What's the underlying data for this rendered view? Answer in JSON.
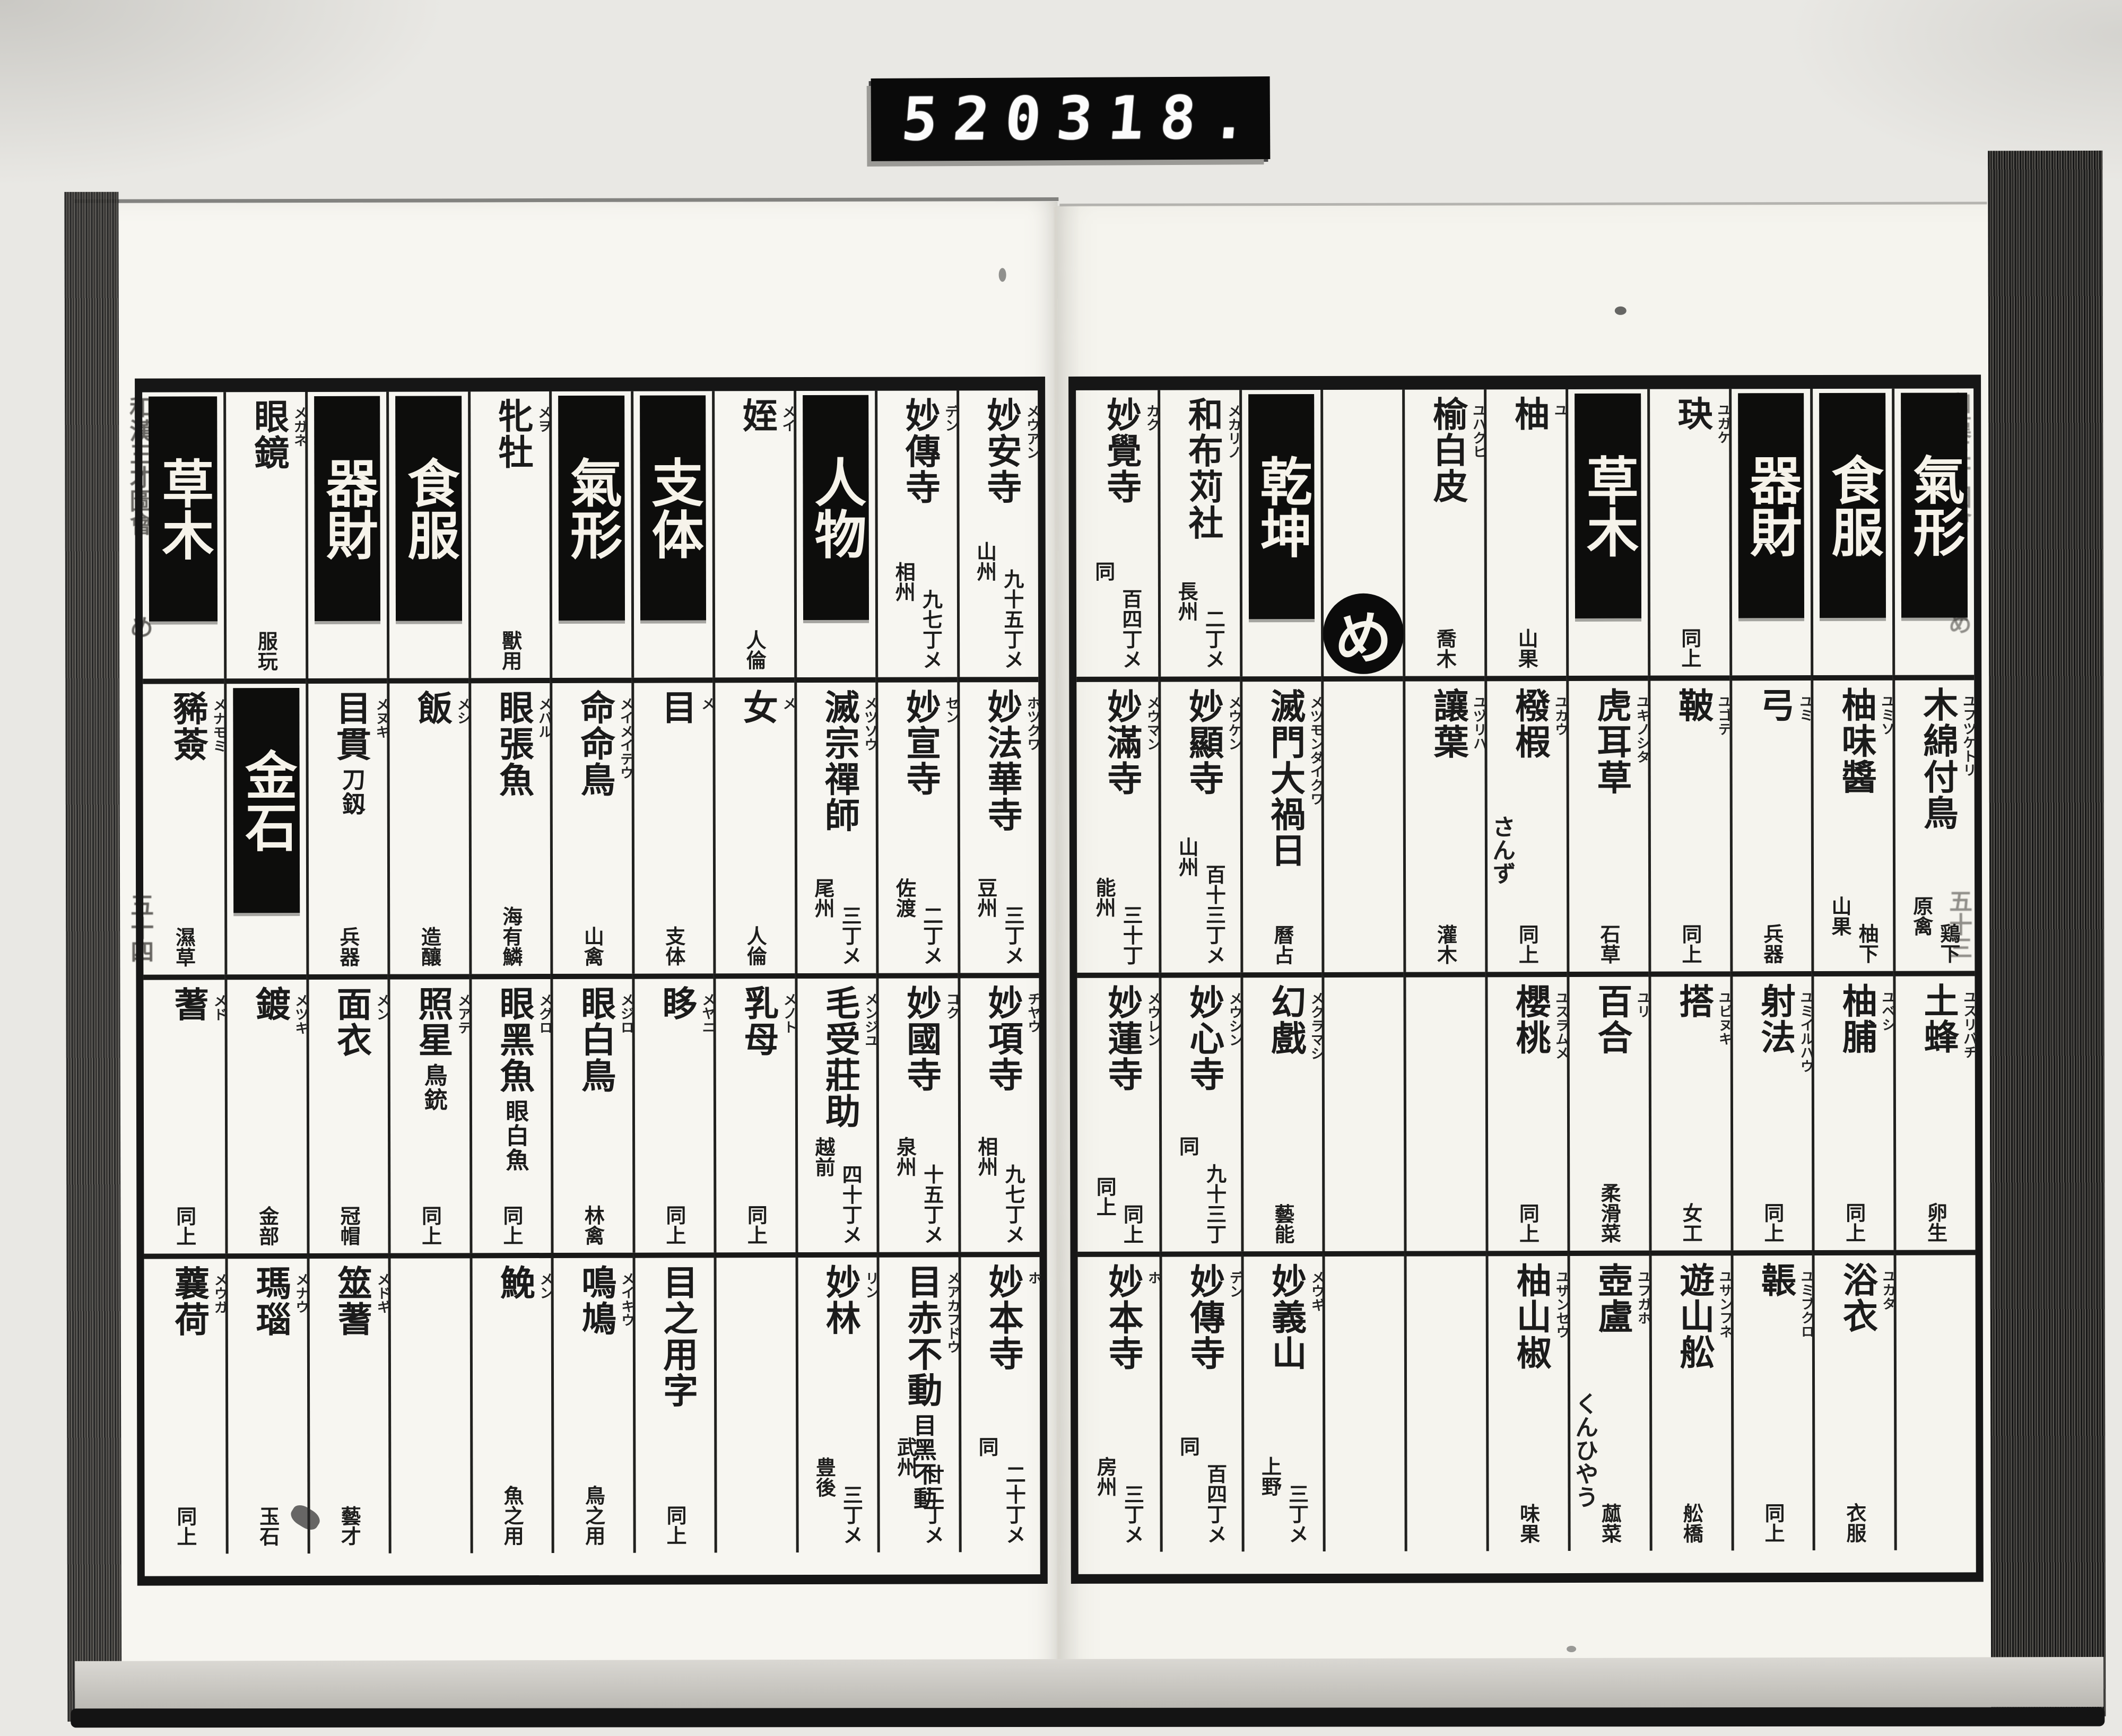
{
  "counter": {
    "left": "520",
    "right": "318."
  },
  "margins": {
    "left": {
      "title": "和漢三才圖會",
      "section": "め",
      "page": "五十四"
    },
    "right": {
      "title": "和漢三才圖會",
      "section": "め",
      "page": "五十三"
    }
  },
  "pages": [
    {
      "side": "right",
      "columns": [
        {
          "cells": [
            {
              "type": "header",
              "text": "氣形"
            },
            {
              "type": "entry",
              "text": "木綿付鳥",
              "furigana": "ユフツケトリ",
              "notes": [
                "原禽",
                "鶏下"
              ]
            },
            {
              "type": "entry",
              "text": "土蜂",
              "furigana": "ユスリバチ",
              "notes": [
                "卵生"
              ]
            },
            {
              "type": "empty"
            }
          ]
        },
        {
          "cells": [
            {
              "type": "header",
              "text": "食服"
            },
            {
              "type": "entry",
              "text": "柚味醬",
              "furigana": "ユミソ",
              "notes": [
                "山果",
                "柚下"
              ]
            },
            {
              "type": "entry",
              "text": "柚脯",
              "furigana": "ユベシ",
              "notes": [
                "同上"
              ]
            },
            {
              "type": "entry",
              "text": "浴衣",
              "furigana": "ユカタ",
              "notes": [
                "衣服"
              ]
            }
          ]
        },
        {
          "cells": [
            {
              "type": "header",
              "text": "器財"
            },
            {
              "type": "entry",
              "text": "弓",
              "furigana": "ユミ",
              "notes": [
                "兵器"
              ]
            },
            {
              "type": "entry",
              "text": "射法",
              "furigana": "ユミイルハウ",
              "notes": [
                "同上"
              ]
            },
            {
              "type": "entry",
              "text": "韔",
              "furigana": "ユミブクロ",
              "notes": [
                "同上"
              ]
            }
          ]
        },
        {
          "cells": [
            {
              "type": "entry",
              "text": "玦",
              "furigana": "ユガケ",
              "notes": [
                "同上"
              ]
            },
            {
              "type": "entry",
              "text": "鞁",
              "furigana": "ユゴテ",
              "notes": [
                "同上"
              ]
            },
            {
              "type": "entry",
              "text": "搭",
              "furigana": "ユビヌキ",
              "notes": [
                "女工"
              ]
            },
            {
              "type": "entry",
              "text": "遊山舩",
              "furigana": "ユサンフネ",
              "notes": [
                "舩橋"
              ]
            }
          ]
        },
        {
          "cells": [
            {
              "type": "header",
              "text": "草木"
            },
            {
              "type": "entry",
              "text": "虎耳草",
              "furigana": "ユキノシタ",
              "notes": [
                "石草"
              ]
            },
            {
              "type": "entry",
              "text": "百合",
              "furigana": "ユリ",
              "notes": [
                "柔滑菜"
              ]
            },
            {
              "type": "entry",
              "text": "壺盧",
              "furigana": "ユフガホ",
              "kana": "くんひやう",
              "notes": [
                "蓏菜"
              ]
            }
          ]
        },
        {
          "cells": [
            {
              "type": "entry",
              "text": "柚",
              "furigana": "ユ",
              "notes": [
                "山果"
              ]
            },
            {
              "type": "entry",
              "text": "橃椵",
              "furigana": "ユカウ",
              "kana": "さんず",
              "notes": [
                "同上"
              ]
            },
            {
              "type": "entry",
              "text": "櫻桃",
              "furigana": "ユスラムメ",
              "notes": [
                "同上"
              ]
            },
            {
              "type": "entry",
              "text": "柚山椒",
              "furigana": "ユザンセウ",
              "notes": [
                "味果"
              ]
            }
          ]
        },
        {
          "cells": [
            {
              "type": "entry",
              "text": "榆白皮",
              "furigana": "ユハクヒ",
              "notes": [
                "喬木"
              ]
            },
            {
              "type": "entry",
              "text": "讓葉",
              "furigana": "ユヅリハ",
              "notes": [
                "灌木"
              ]
            },
            {
              "type": "empty"
            },
            {
              "type": "empty"
            }
          ]
        },
        {
          "cells": [
            {
              "type": "marker",
              "text": "め"
            },
            {
              "type": "empty"
            },
            {
              "type": "empty"
            },
            {
              "type": "empty"
            }
          ]
        },
        {
          "cells": [
            {
              "type": "header",
              "text": "乾坤"
            },
            {
              "type": "entry",
              "text": "滅門大禍日",
              "furigana": "メツモンダイクワ",
              "notes": [
                "曆占"
              ]
            },
            {
              "type": "entry",
              "text": "幻戲",
              "furigana": "メクラマシ",
              "notes": [
                "藝能"
              ]
            },
            {
              "type": "entry",
              "text": "妙義山",
              "furigana": "メウギ",
              "notes": [
                "上野",
                "三丁メ"
              ]
            }
          ]
        },
        {
          "cells": [
            {
              "type": "entry",
              "text": "和布苅社",
              "furigana": "メカリノ",
              "notes": [
                "長州",
                "二丁メ"
              ]
            },
            {
              "type": "entry",
              "text": "妙顯寺",
              "furigana": "メウケン",
              "notes": [
                "山州",
                "百十三丁メ"
              ]
            },
            {
              "type": "entry",
              "text": "妙心寺",
              "furigana": "メウシン",
              "notes": [
                "同",
                "九十三丁"
              ]
            },
            {
              "type": "entry",
              "text": "妙傳寺",
              "furigana": "デン",
              "notes": [
                "同",
                "百四丁メ"
              ]
            }
          ]
        },
        {
          "cells": [
            {
              "type": "entry",
              "text": "妙覺寺",
              "furigana": "カク",
              "notes": [
                "同",
                "百四丁メ"
              ]
            },
            {
              "type": "entry",
              "text": "妙滿寺",
              "furigana": "メウマン",
              "notes": [
                "能州",
                "三十丁"
              ]
            },
            {
              "type": "entry",
              "text": "妙蓮寺",
              "furigana": "メウレン",
              "notes": [
                "同上",
                "同上"
              ]
            },
            {
              "type": "entry",
              "text": "妙本寺",
              "furigana": "ホ",
              "notes": [
                "房州",
                "三丁メ"
              ]
            }
          ]
        }
      ]
    },
    {
      "side": "left",
      "columns": [
        {
          "cells": [
            {
              "type": "entry",
              "text": "妙安寺",
              "furigana": "メウアン",
              "notes": [
                "山州",
                "九十五丁メ"
              ]
            },
            {
              "type": "entry",
              "text": "妙法華寺",
              "furigana": "ホツクワ",
              "notes": [
                "豆州",
                "三丁メ"
              ]
            },
            {
              "type": "entry",
              "text": "妙項寺",
              "furigana": "チヤウ",
              "notes": [
                "相州",
                "九七丁メ"
              ]
            },
            {
              "type": "entry",
              "text": "妙本寺",
              "furigana": "ホ",
              "notes": [
                "同",
                "二十丁メ"
              ]
            }
          ]
        },
        {
          "cells": [
            {
              "type": "entry",
              "text": "妙傳寺",
              "furigana": "デン",
              "notes": [
                "相州",
                "九七丁メ"
              ]
            },
            {
              "type": "entry",
              "text": "妙宣寺",
              "furigana": "セン",
              "notes": [
                "佐渡",
                "二丁メ"
              ]
            },
            {
              "type": "entry",
              "text": "妙國寺",
              "furigana": "コク",
              "notes": [
                "泉州",
                "十五丁メ"
              ]
            },
            {
              "type": "entry",
              "text": "目赤不動",
              "sub": "目黑不動",
              "furigana": "メアカフドウ",
              "notes": [
                "武州",
                "廿二丁メ"
              ]
            }
          ]
        },
        {
          "cells": [
            {
              "type": "header",
              "text": "人物"
            },
            {
              "type": "entry",
              "text": "滅宗禪師",
              "furigana": "メツソウ",
              "notes": [
                "尾州",
                "三丁メ"
              ]
            },
            {
              "type": "entry",
              "text": "毛受莊助",
              "furigana": "メンジユ",
              "notes": [
                "越前",
                "四十丁メ"
              ]
            },
            {
              "type": "entry",
              "text": "妙林",
              "furigana": "リン",
              "notes": [
                "豊後",
                "三丁メ"
              ]
            }
          ]
        },
        {
          "cells": [
            {
              "type": "entry",
              "text": "姪",
              "furigana": "メイ",
              "notes": [
                "人倫"
              ]
            },
            {
              "type": "entry",
              "text": "女",
              "furigana": "メ",
              "notes": [
                "人倫"
              ]
            },
            {
              "type": "entry",
              "text": "乳母",
              "furigana": "メノト",
              "notes": [
                "同上"
              ]
            },
            {
              "type": "empty"
            }
          ]
        },
        {
          "cells": [
            {
              "type": "header",
              "text": "支体"
            },
            {
              "type": "entry",
              "text": "目",
              "furigana": "メ",
              "notes": [
                "支体"
              ]
            },
            {
              "type": "entry",
              "text": "眵",
              "furigana": "メヤニ",
              "notes": [
                "同上"
              ]
            },
            {
              "type": "entry",
              "text": "目之用字",
              "notes": [
                "同上"
              ]
            }
          ]
        },
        {
          "cells": [
            {
              "type": "header",
              "text": "氣形"
            },
            {
              "type": "entry",
              "text": "命命鳥",
              "furigana": "メイメイテウ",
              "notes": [
                "山禽"
              ]
            },
            {
              "type": "entry",
              "text": "眼白鳥",
              "furigana": "メジロ",
              "notes": [
                "林禽"
              ]
            },
            {
              "type": "entry",
              "text": "鳴鳩",
              "furigana": "メイキウ",
              "notes": [
                "鳥之用"
              ]
            }
          ]
        },
        {
          "cells": [
            {
              "type": "entry",
              "text": "牝牡",
              "furigana": "メヲ",
              "notes": [
                "獸用"
              ]
            },
            {
              "type": "entry",
              "text": "眼張魚",
              "furigana": "メバル",
              "notes": [
                "海有鱗"
              ]
            },
            {
              "type": "entry",
              "text": "眼黑魚",
              "sub": "眼白魚",
              "furigana": "メグロ",
              "notes": [
                "同上"
              ]
            },
            {
              "type": "entry",
              "text": "鮸",
              "furigana": "メン",
              "notes": [
                "魚之用"
              ]
            }
          ]
        },
        {
          "cells": [
            {
              "type": "header",
              "text": "食服"
            },
            {
              "type": "entry",
              "text": "飯",
              "furigana": "メシ",
              "notes": [
                "造釀"
              ]
            },
            {
              "type": "entry",
              "text": "照星",
              "sub": "鳥銃",
              "furigana": "メアテ",
              "notes": [
                "同上"
              ]
            },
            {
              "type": "empty"
            }
          ]
        },
        {
          "cells": [
            {
              "type": "header",
              "text": "器財"
            },
            {
              "type": "entry",
              "text": "目貫",
              "sub": "刀釼",
              "furigana": "メヌキ",
              "notes": [
                "兵器"
              ]
            },
            {
              "type": "entry",
              "text": "面衣",
              "furigana": "メン",
              "notes": [
                "冠帽"
              ]
            },
            {
              "type": "entry",
              "text": "筮蓍",
              "furigana": "メドギ",
              "notes": [
                "藝才"
              ]
            }
          ]
        },
        {
          "cells": [
            {
              "type": "entry",
              "text": "眼鏡",
              "furigana": "メガネ",
              "notes": [
                "服玩"
              ]
            },
            {
              "type": "header",
              "text": "金石"
            },
            {
              "type": "entry",
              "text": "鍍",
              "furigana": "メツキ",
              "notes": [
                "金部"
              ]
            },
            {
              "type": "entry",
              "text": "瑪瑙",
              "furigana": "メナウ",
              "notes": [
                "玉石"
              ]
            }
          ]
        },
        {
          "cells": [
            {
              "type": "header",
              "text": "草木"
            },
            {
              "type": "entry",
              "text": "豨薟",
              "furigana": "メナモミ",
              "notes": [
                "濕草"
              ]
            },
            {
              "type": "entry",
              "text": "蓍",
              "furigana": "メド",
              "notes": [
                "同上"
              ]
            },
            {
              "type": "entry",
              "text": "蘘荷",
              "furigana": "メウガ",
              "notes": [
                "同上"
              ]
            }
          ]
        }
      ]
    }
  ]
}
